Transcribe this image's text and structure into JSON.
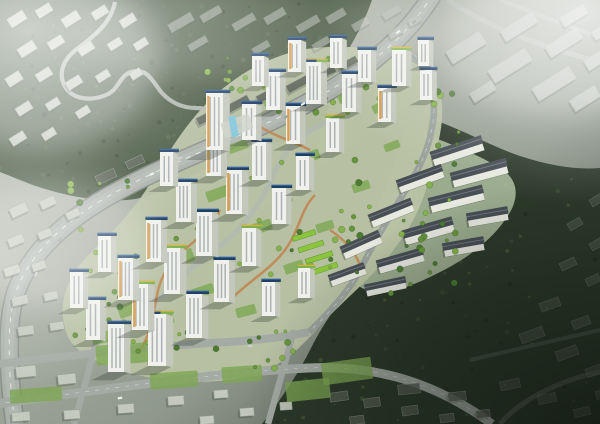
{
  "image": {
    "kind": "architectural-aerial-rendering",
    "description": "Bird's-eye rendering of a hillside apartment complex: white residential towers with rooftop solar panels and green roofs, terraced low-rise housing, landscaped paths, surrounded by muted gray city blocks, a forested hill with a winding road to the northwest, a large park forest to the east, haze in the corners and a dark vignette at lower right.",
    "visible_text": []
  },
  "palette": {
    "ground_light": "#b9beb2",
    "ground_mid": "#9aa296",
    "ground_dark": "#39423a",
    "forest_base": "#45573f",
    "forest_dark": "#2a3628",
    "forest_light": "#5d7050",
    "park_base": "#2c3a2a",
    "road": "#aab0aa",
    "road_edge": "#848a84",
    "road_inner": "#b6bcb6",
    "minor_road": "#a4aaa4",
    "ring_road": "#9aa19b",
    "context_top": "#c7ccc0",
    "context_side": "#999f93",
    "context_dark": "#596055",
    "slab_top": "#b6bcb4",
    "tower_face": "#f0f1ec",
    "tower_side": "#c3c7bc",
    "tower_window": "#7f8890",
    "roof_solar": "#1f3f66",
    "roof_solar_hi": "#3a6ea5",
    "roof_green": "#7fb04a",
    "trim_yellow": "#e6b53a",
    "accent_orange": "#e09a3d",
    "tree_dark": "#4c7a33",
    "tree_mid": "#67953d",
    "tree_light": "#85b24b",
    "lawn": "#7da653",
    "garden_green": "#8cc43e",
    "path_orange": "#c08049",
    "complex_ground": "#b9c2a4",
    "terrace_ground": "#aebfa0",
    "terrace_roof": "#474e54",
    "terrace_body": "#e7e9e1",
    "glass_blue": "#7fc6dd",
    "fog": "#ffffff",
    "vignette": "#0a0f0a"
  },
  "scene": {
    "context_styles": {
      "tl": {
        "fill": "context_top",
        "opacity": 0.95
      },
      "ridge": {
        "fill": "slab_top",
        "opacity": 0.55
      },
      "tr": {
        "fill": "slab_top",
        "opacity": 0.95
      },
      "west": {
        "fill": "context_top",
        "opacity": 0.9
      },
      "bottom": {
        "fill": "context_top",
        "opacity": 0.95
      },
      "dark_slabs": {
        "fill": "context_dark",
        "opacity": 0.9
      },
      "bottom_dark": {
        "fill": "context_dark",
        "opacity": 0.8
      },
      "br": {
        "fill": "context_dark",
        "opacity": 0.5
      }
    },
    "context": {
      "tl": [
        [
          8,
          14,
          18,
          10,
          -32
        ],
        [
          36,
          6,
          16,
          9,
          -32
        ],
        [
          62,
          14,
          18,
          10,
          -32
        ],
        [
          92,
          8,
          16,
          9,
          -32
        ],
        [
          120,
          16,
          16,
          9,
          -32
        ],
        [
          18,
          44,
          18,
          10,
          -32
        ],
        [
          48,
          38,
          16,
          9,
          -32
        ],
        [
          78,
          44,
          16,
          9,
          -32
        ],
        [
          108,
          40,
          14,
          8,
          -32
        ],
        [
          6,
          74,
          16,
          10,
          -32
        ],
        [
          36,
          70,
          16,
          9,
          -32
        ],
        [
          66,
          78,
          16,
          9,
          -32
        ],
        [
          96,
          72,
          14,
          8,
          -32
        ],
        [
          16,
          104,
          16,
          9,
          -32
        ],
        [
          46,
          100,
          14,
          8,
          -32
        ],
        [
          76,
          108,
          14,
          8,
          -32
        ],
        [
          10,
          134,
          16,
          9,
          -32
        ],
        [
          42,
          130,
          14,
          8,
          -32
        ],
        [
          134,
          40,
          14,
          8,
          -32
        ],
        [
          130,
          70,
          12,
          8,
          -32
        ]
      ],
      "ridge": [
        [
          168,
          18,
          26,
          9,
          -30
        ],
        [
          200,
          10,
          22,
          8,
          -30
        ],
        [
          232,
          18,
          24,
          8,
          -30
        ],
        [
          264,
          12,
          22,
          8,
          -30
        ],
        [
          296,
          20,
          24,
          8,
          -30
        ],
        [
          326,
          12,
          20,
          8,
          -30
        ],
        [
          352,
          20,
          18,
          8,
          -30
        ],
        [
          382,
          8,
          20,
          8,
          -30
        ],
        [
          188,
          40,
          20,
          7,
          -30
        ],
        [
          252,
          44,
          18,
          7,
          -30
        ],
        [
          312,
          40,
          18,
          7,
          -30
        ],
        [
          388,
          28,
          16,
          8,
          -30
        ],
        [
          408,
          16,
          14,
          8,
          -30
        ]
      ],
      "tr": [
        [
          446,
          40,
          40,
          15,
          -32
        ],
        [
          488,
          58,
          44,
          15,
          -32
        ],
        [
          532,
          76,
          44,
          15,
          -32
        ],
        [
          570,
          92,
          30,
          13,
          -32
        ],
        [
          500,
          20,
          38,
          13,
          -32
        ],
        [
          545,
          36,
          38,
          13,
          -32
        ],
        [
          584,
          52,
          30,
          12,
          -32
        ],
        [
          470,
          86,
          26,
          11,
          -32
        ],
        [
          560,
          10,
          28,
          11,
          -32
        ],
        [
          592,
          26,
          20,
          10,
          -32
        ]
      ],
      "west": [
        [
          10,
          205,
          18,
          10,
          -25
        ],
        [
          40,
          198,
          16,
          9,
          -25
        ],
        [
          66,
          210,
          14,
          8,
          -25
        ],
        [
          8,
          236,
          16,
          9,
          -22
        ],
        [
          38,
          230,
          14,
          8,
          -22
        ],
        [
          4,
          266,
          16,
          9,
          -18
        ],
        [
          32,
          262,
          14,
          8,
          -18
        ],
        [
          12,
          296,
          16,
          9,
          -12
        ],
        [
          44,
          292,
          14,
          8,
          -12
        ],
        [
          18,
          326,
          16,
          9,
          -8
        ],
        [
          50,
          322,
          14,
          8,
          -8
        ]
      ],
      "bottom": [
        [
          16,
          366,
          20,
          11,
          -6
        ],
        [
          58,
          374,
          18,
          10,
          -6
        ],
        [
          150,
          352,
          16,
          9,
          -6
        ],
        [
          12,
          412,
          18,
          9,
          -4
        ],
        [
          64,
          410,
          16,
          9,
          -4
        ],
        [
          118,
          404,
          16,
          9,
          -4
        ],
        [
          168,
          396,
          16,
          9,
          -4
        ],
        [
          214,
          390,
          14,
          8,
          -4
        ],
        [
          240,
          408,
          14,
          8,
          -4
        ],
        [
          280,
          402,
          12,
          8,
          -4
        ],
        [
          200,
          416,
          14,
          8,
          -4
        ]
      ],
      "dark_slabs": [
        [
          196,
          112,
          26,
          8,
          -28
        ],
        [
          226,
          100,
          24,
          8,
          -28
        ],
        [
          256,
          90,
          26,
          8,
          -28
        ],
        [
          286,
          80,
          24,
          8,
          -28
        ],
        [
          314,
          70,
          22,
          7,
          -28
        ],
        [
          338,
          60,
          20,
          7,
          -28
        ],
        [
          96,
          172,
          20,
          9,
          -25
        ],
        [
          126,
          158,
          18,
          8,
          -25
        ]
      ],
      "bottom_dark": [
        [
          330,
          392,
          18,
          9,
          -8
        ],
        [
          364,
          398,
          16,
          9,
          -8
        ],
        [
          402,
          406,
          16,
          9,
          -8
        ],
        [
          440,
          414,
          14,
          8,
          -8
        ],
        [
          476,
          410,
          14,
          8,
          -8
        ],
        [
          350,
          416,
          14,
          8,
          -8
        ],
        [
          398,
          384,
          22,
          10,
          -6
        ],
        [
          448,
          392,
          18,
          9,
          -6
        ]
      ],
      "br": [
        [
          520,
          330,
          24,
          10,
          -20
        ],
        [
          556,
          348,
          22,
          10,
          -20
        ],
        [
          586,
          366,
          18,
          9,
          -20
        ],
        [
          540,
          300,
          20,
          9,
          -20
        ],
        [
          572,
          318,
          18,
          9,
          -20
        ],
        [
          500,
          380,
          20,
          9,
          -12
        ],
        [
          538,
          394,
          18,
          9,
          -12
        ],
        [
          574,
          408,
          16,
          8,
          -12
        ],
        [
          596,
          390,
          14,
          8,
          -12
        ],
        [
          560,
          260,
          16,
          8,
          -25
        ],
        [
          586,
          276,
          14,
          8,
          -25
        ],
        [
          590,
          240,
          14,
          8,
          -30
        ],
        [
          568,
          220,
          14,
          8,
          -30
        ],
        [
          590,
          196,
          14,
          8,
          -30
        ]
      ]
    },
    "towers": [
      [
        108,
        372,
        16,
        48,
        "s",
        0
      ],
      [
        148,
        366,
        18,
        52,
        "sg",
        0
      ],
      [
        86,
        340,
        14,
        40,
        "s",
        0
      ],
      [
        132,
        330,
        16,
        46,
        "g",
        1
      ],
      [
        186,
        338,
        16,
        44,
        "s",
        0
      ],
      [
        70,
        308,
        13,
        36,
        "s",
        0
      ],
      [
        118,
        300,
        15,
        42,
        "s",
        1
      ],
      [
        164,
        294,
        16,
        46,
        "g",
        0
      ],
      [
        214,
        302,
        15,
        42,
        "s",
        0
      ],
      [
        98,
        272,
        13,
        36,
        "s",
        0
      ],
      [
        146,
        262,
        15,
        42,
        "s",
        1
      ],
      [
        196,
        256,
        16,
        44,
        "s",
        0
      ],
      [
        242,
        266,
        14,
        38,
        "g",
        0
      ],
      [
        176,
        222,
        15,
        40,
        "s",
        0
      ],
      [
        226,
        214,
        16,
        44,
        "s",
        1
      ],
      [
        272,
        224,
        14,
        36,
        "s",
        0
      ],
      [
        160,
        186,
        13,
        34,
        "s",
        0
      ],
      [
        206,
        176,
        15,
        42,
        "g",
        1
      ],
      [
        252,
        180,
        14,
        38,
        "s",
        0
      ],
      [
        296,
        190,
        13,
        34,
        "s",
        0
      ],
      [
        242,
        140,
        14,
        36,
        "s",
        0
      ],
      [
        286,
        144,
        14,
        38,
        "s",
        1
      ],
      [
        326,
        152,
        13,
        34,
        "g",
        0
      ],
      [
        206,
        150,
        17,
        57,
        "s",
        1
      ],
      [
        266,
        110,
        14,
        38,
        "s",
        0
      ],
      [
        306,
        104,
        15,
        42,
        "sg",
        0
      ],
      [
        342,
        112,
        14,
        38,
        "s",
        0
      ],
      [
        378,
        122,
        13,
        34,
        "s",
        1
      ],
      [
        358,
        82,
        13,
        32,
        "s",
        0
      ],
      [
        392,
        86,
        14,
        36,
        "g",
        0
      ],
      [
        420,
        100,
        12,
        30,
        "s",
        0
      ],
      [
        330,
        68,
        12,
        30,
        "s",
        0
      ],
      [
        288,
        72,
        13,
        32,
        "s",
        1
      ],
      [
        252,
        86,
        12,
        30,
        "s",
        0
      ],
      [
        418,
        66,
        11,
        26,
        "s",
        0
      ],
      [
        262,
        316,
        13,
        34,
        "s",
        0
      ],
      [
        298,
        298,
        12,
        30,
        "g",
        0
      ]
    ],
    "terraces": [
      [
        432,
        148,
        52,
        9,
        -18
      ],
      [
        452,
        170,
        56,
        9,
        -15
      ],
      [
        398,
        176,
        46,
        8,
        -20
      ],
      [
        430,
        196,
        54,
        9,
        -14
      ],
      [
        468,
        214,
        40,
        8,
        -10
      ],
      [
        370,
        210,
        44,
        8,
        -22
      ],
      [
        404,
        228,
        50,
        9,
        -16
      ],
      [
        444,
        244,
        40,
        8,
        -10
      ],
      [
        342,
        242,
        40,
        8,
        -24
      ],
      [
        378,
        258,
        46,
        8,
        -16
      ],
      [
        330,
        272,
        36,
        7,
        -20
      ],
      [
        366,
        284,
        40,
        7,
        -12
      ]
    ],
    "lawns": [
      [
        118,
        302,
        26,
        13,
        -20
      ],
      [
        166,
        252,
        28,
        13,
        -20
      ],
      [
        206,
        188,
        24,
        11,
        -20
      ],
      [
        248,
        222,
        24,
        11,
        -20
      ],
      [
        298,
        152,
        22,
        10,
        -20
      ],
      [
        338,
        92,
        20,
        9,
        -20
      ],
      [
        92,
        332,
        22,
        11,
        -15
      ],
      [
        228,
        142,
        20,
        9,
        -20
      ],
      [
        264,
        98,
        18,
        9,
        -25
      ],
      [
        372,
        102,
        18,
        9,
        -25
      ],
      [
        152,
        316,
        22,
        10,
        -18
      ],
      [
        192,
        286,
        22,
        10,
        -18
      ],
      [
        236,
        306,
        20,
        10,
        -15
      ],
      [
        284,
        262,
        20,
        10,
        -18
      ],
      [
        316,
        222,
        18,
        9,
        -18
      ],
      [
        352,
        182,
        18,
        9,
        -18
      ],
      [
        384,
        142,
        16,
        8,
        -20
      ],
      [
        96,
        344,
        52,
        20,
        -4
      ],
      [
        10,
        388,
        52,
        14,
        -4
      ],
      [
        150,
        372,
        48,
        16,
        -4
      ],
      [
        222,
        366,
        40,
        16,
        -4
      ],
      [
        286,
        380,
        44,
        20,
        -6
      ],
      [
        322,
        360,
        50,
        22,
        -8
      ]
    ],
    "gardens": [
      [
        298,
        244,
        26,
        5,
        -18
      ],
      [
        305,
        255,
        28,
        5,
        -18
      ],
      [
        312,
        266,
        26,
        5,
        -18
      ],
      [
        292,
        233,
        24,
        5,
        -18
      ]
    ],
    "tree_bands": [
      [
        70,
        180,
        70,
        170,
        24
      ],
      [
        190,
        58,
        220,
        55,
        22
      ],
      [
        396,
        118,
        64,
        170,
        20
      ],
      [
        118,
        330,
        190,
        44,
        18
      ],
      [
        150,
        150,
        210,
        160,
        20
      ],
      [
        330,
        196,
        120,
        100,
        16
      ],
      [
        424,
        52,
        30,
        60,
        8
      ],
      [
        86,
        240,
        50,
        110,
        14
      ]
    ],
    "speckle_areas": [
      {
        "target": "speckles-forest",
        "x": 0,
        "y": 0,
        "w": 370,
        "h": 205,
        "count": 170,
        "colors": [
          "forest_light",
          "forest_dark",
          "#55684a"
        ]
      },
      {
        "target": "speckles-park",
        "x": 266,
        "y": 100,
        "w": 334,
        "h": 324,
        "count": 190,
        "colors": [
          "#1f2a1e",
          "#3e5336",
          "#4e6a40"
        ]
      }
    ],
    "vehicles": [
      [
        303,
        104,
        -30
      ],
      [
        286,
        117,
        -30
      ],
      [
        180,
        158,
        -25
      ],
      [
        152,
        174,
        -25
      ],
      [
        60,
        240,
        -52
      ],
      [
        36,
        274,
        -64
      ],
      [
        398,
        32,
        -38
      ],
      [
        414,
        22,
        -38
      ],
      [
        250,
        346,
        -4
      ],
      [
        120,
        398,
        -8
      ]
    ]
  }
}
